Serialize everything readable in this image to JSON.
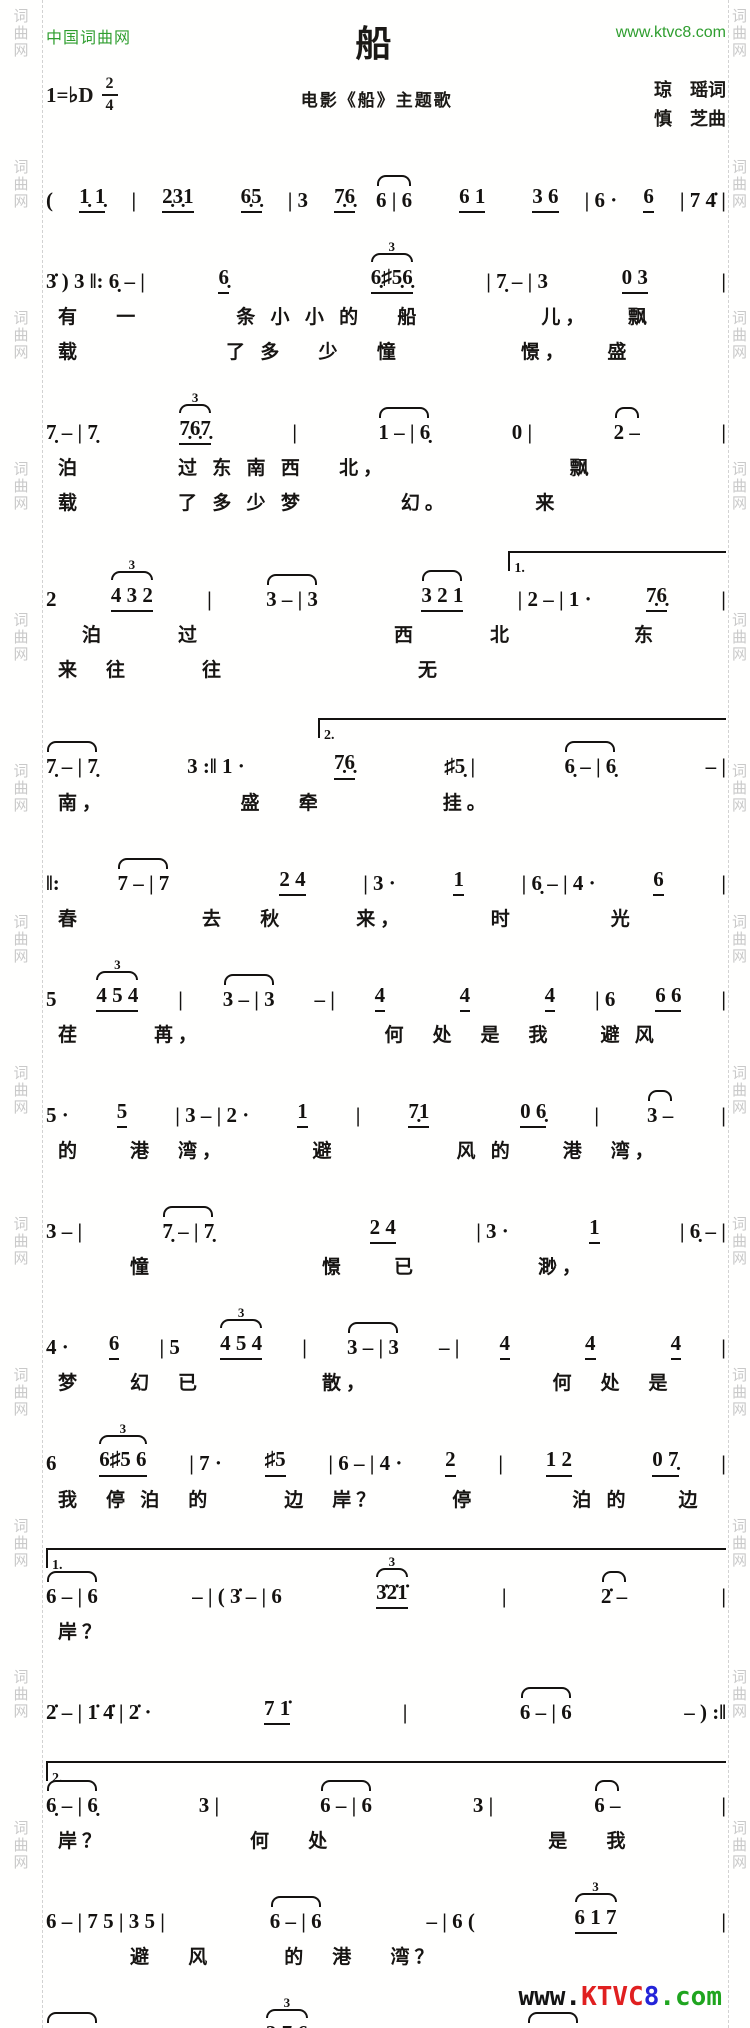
{
  "header": {
    "site_name": "中国词曲网",
    "site_url": "www.ktvc8.com",
    "title": "船",
    "key_signature": "1=♭D",
    "time_top": "2",
    "time_bottom": "4",
    "subtitle": "电影《船》主题歌",
    "lyricist": "琼　瑶词",
    "composer": "慎　芝曲"
  },
  "watermark": {
    "chars": [
      "词",
      "曲",
      "网"
    ],
    "groups": 13
  },
  "footer_logo": {
    "www": "www.",
    "ktvc": "KTVC",
    "eight": "8",
    "com": ".com"
  },
  "colors": {
    "site_green": "#2f9e2f",
    "logo_red": "#e02020",
    "logo_blue": "#2424d8",
    "logo_green": "#1fa51f",
    "ink": "#141210",
    "watermark_gray": "#c9c9c9"
  },
  "systems": [
    {
      "tokens": [
        {
          "t": "( "
        },
        {
          "t": "1̣ 1̣",
          "u": 1
        },
        {
          "t": " | "
        },
        {
          "t": "2̣3̣1",
          "u": 1
        },
        {
          "t": " "
        },
        {
          "t": "6̣5̣",
          "u": 1
        },
        {
          "t": " | 3 "
        },
        {
          "t": "7̣6̣",
          "u": 1
        },
        {
          "t": "6 | 6",
          "slur": 1
        },
        {
          "t": " "
        },
        {
          "t": "6 1",
          "u": 1
        },
        {
          "t": " "
        },
        {
          "t": "3 6",
          "u": 1
        },
        {
          "t": " | 6 · "
        },
        {
          "t": "6",
          "u": 1
        },
        {
          "t": " | 7 4̇ |"
        }
      ],
      "lyrics": []
    },
    {
      "tokens": [
        {
          "t": "3̇ ) 3 ‖: 6̣ – | "
        },
        {
          "t": "6̣",
          "u": 1
        },
        {
          "t": " "
        },
        {
          "t": "6̣♯5̣6̣",
          "u": 1,
          "tri": "3"
        },
        {
          "t": " | 7̣ – | 3 "
        },
        {
          "t": "0 3",
          "u": 1
        },
        {
          "t": " |"
        }
      ],
      "lyrics": [
        "有　 一　　　　条 小 小 的　 船　　　　　儿，　　飘",
        "载　　　　　　了 多　 少　 憧　　　　　憬，　　盛"
      ]
    },
    {
      "tokens": [
        {
          "t": "7̣ – | 7̣ "
        },
        {
          "t": "7̣6̣7̣",
          "u": 1,
          "tri": "3"
        },
        {
          "t": " | "
        },
        {
          "t": "1 – | 6̣",
          "slur": 1
        },
        {
          "t": " 0 | "
        },
        {
          "t": "2 –",
          "slur": 1
        },
        {
          "t": " |"
        }
      ],
      "lyrics": [
        "泊　　　　过 东 南 西　 北，　　　　　　　　飘",
        "载　　　　了 多 少 梦　　　　幻。　　　　来"
      ]
    },
    {
      "volta": {
        "label": "1.",
        "left": 68,
        "width": 32
      },
      "tokens": [
        {
          "t": "2 "
        },
        {
          "t": "4 3 2",
          "u": 1,
          "tri": "3"
        },
        {
          "t": " | "
        },
        {
          "t": "3 – | 3",
          "slur": 1
        },
        {
          "t": " "
        },
        {
          "t": "3 2 1",
          "u": 1,
          "slur": 1
        },
        {
          "t": " | 2 – | 1 · "
        },
        {
          "t": "7̣6̣",
          "u": 1
        },
        {
          "t": " |"
        }
      ],
      "lyrics": [
        "　泊　　　过　　　　　　　　西　　　北　　　　　东",
        "来　往　　　往　　　　　　　　无"
      ]
    },
    {
      "volta": {
        "label": "2.",
        "left": 40,
        "width": 60
      },
      "tokens": [
        {
          "t": "7̣ – | 7̣",
          "slur": 1
        },
        {
          "t": " 3 :‖ 1 · "
        },
        {
          "t": "7̣6̣",
          "u": 1
        },
        {
          "t": " ♯5̣ | "
        },
        {
          "t": "6̣ – | 6̣",
          "slur": 1
        },
        {
          "t": " – |"
        }
      ],
      "lyrics": [
        "南，　　　　　　盛　 牵　　　　　挂。"
      ]
    },
    {
      "tokens": [
        {
          "t": "‖: "
        },
        {
          "t": "7 – | 7",
          "slur": 1
        },
        {
          "t": " "
        },
        {
          "t": "2 4",
          "u": 1
        },
        {
          "t": " | 3 · "
        },
        {
          "t": "1",
          "u": 1
        },
        {
          "t": " | 6̣ – | 4 · "
        },
        {
          "t": "6",
          "u": 1
        },
        {
          "t": " |"
        }
      ],
      "lyrics": [
        "春　　　　　去　 秋　　　来，　　　　时　　　　光"
      ]
    },
    {
      "tokens": [
        {
          "t": "5 "
        },
        {
          "t": "4 5 4",
          "u": 1,
          "tri": "3"
        },
        {
          "t": " | "
        },
        {
          "t": "3 – | 3",
          "slur": 1
        },
        {
          "t": " – | "
        },
        {
          "t": "4",
          "u": 1
        },
        {
          "t": " "
        },
        {
          "t": "4",
          "u": 1
        },
        {
          "t": " "
        },
        {
          "t": "4",
          "u": 1
        },
        {
          "t": " | 6 "
        },
        {
          "t": "6 6",
          "u": 1
        },
        {
          "t": " |"
        }
      ],
      "lyrics": [
        "荏　　　苒，　　　　　　　　何　处　是　我　　避 风"
      ]
    },
    {
      "tokens": [
        {
          "t": "5 · "
        },
        {
          "t": "5",
          "u": 1
        },
        {
          "t": " | 3 – | 2 · "
        },
        {
          "t": "1",
          "u": 1
        },
        {
          "t": " | "
        },
        {
          "t": "7̣1",
          "u": 1
        },
        {
          "t": " "
        },
        {
          "t": "0 6̣",
          "u": 1
        },
        {
          "t": " | "
        },
        {
          "t": "3 –",
          "slur": 1
        },
        {
          "t": " |"
        }
      ],
      "lyrics": [
        "的　　港　湾，　　　　避　　　　　风 的　　港　湾，"
      ]
    },
    {
      "tokens": [
        {
          "t": "3 – | "
        },
        {
          "t": "7̣ – | 7̣",
          "slur": 1
        },
        {
          "t": " "
        },
        {
          "t": "2 4",
          "u": 1
        },
        {
          "t": " | 3 · "
        },
        {
          "t": "1",
          "u": 1
        },
        {
          "t": " | 6̣ – |"
        }
      ],
      "lyrics": [
        "　　　憧　　　　　　　憬　　已　　　　　渺，"
      ]
    },
    {
      "tokens": [
        {
          "t": "4 · "
        },
        {
          "t": "6",
          "u": 1
        },
        {
          "t": " | 5 "
        },
        {
          "t": "4 5 4",
          "u": 1,
          "tri": "3"
        },
        {
          "t": " | "
        },
        {
          "t": "3 – | 3",
          "slur": 1
        },
        {
          "t": " – | "
        },
        {
          "t": "4",
          "u": 1
        },
        {
          "t": " "
        },
        {
          "t": "4",
          "u": 1
        },
        {
          "t": " "
        },
        {
          "t": "4",
          "u": 1
        },
        {
          "t": " |"
        }
      ],
      "lyrics": [
        "梦　　幻　已　　　　　散，　　　　　　　　何　处　是"
      ]
    },
    {
      "tokens": [
        {
          "t": "6 "
        },
        {
          "t": "6♯5 6",
          "u": 1,
          "tri": "3"
        },
        {
          "t": " | 7 · "
        },
        {
          "t": "♯5",
          "u": 1
        },
        {
          "t": " | 6 – | 4 · "
        },
        {
          "t": "2",
          "u": 1
        },
        {
          "t": " | "
        },
        {
          "t": "1 2",
          "u": 1
        },
        {
          "t": " "
        },
        {
          "t": "0 7̣",
          "u": 1
        },
        {
          "t": " |"
        }
      ],
      "lyrics": [
        "我　停 泊　的　　　边　岸？　　　停　　　　泊 的　　边"
      ]
    },
    {
      "volta": {
        "label": "1.",
        "left": 0,
        "width": 100
      },
      "tokens": [
        {
          "t": "6 – | 6",
          "slur": 1
        },
        {
          "t": " – | ( 3̇ – | 6 "
        },
        {
          "t": "3̇2̇1̇",
          "u": 1,
          "tri": "3"
        },
        {
          "t": " | "
        },
        {
          "t": "2̇ –",
          "slur": 1
        },
        {
          "t": " |"
        }
      ],
      "lyrics": [
        "岸？"
      ]
    },
    {
      "tokens": [
        {
          "t": "2̇ – | 1̇ 4̇ | 2̇ · "
        },
        {
          "t": "7 1̇",
          "u": 1
        },
        {
          "t": " | "
        },
        {
          "t": "6 – | 6",
          "slur": 1
        },
        {
          "t": " – ) :‖"
        }
      ],
      "lyrics": []
    },
    {
      "volta": {
        "label": "2.",
        "left": 0,
        "width": 100
      },
      "tokens": [
        {
          "t": "6̣ – | 6̣",
          "slur": 1
        },
        {
          "t": " 3 | "
        },
        {
          "t": "6 – | 6",
          "slur": 1
        },
        {
          "t": " 3 | "
        },
        {
          "t": "6 –",
          "slur": 1
        },
        {
          "t": " |"
        }
      ],
      "lyrics": [
        "岸？　　　　　　何　 处　　　　　　　　　是　 我"
      ]
    },
    {
      "tokens": [
        {
          "t": "6 – | 7 5 | 3 5 | "
        },
        {
          "t": "6 – | 6",
          "slur": 1
        },
        {
          "t": " – | 6 ("
        },
        {
          "t": "6 1 7",
          "u": 1,
          "tri": "3"
        },
        {
          "t": " |"
        }
      ],
      "lyrics": [
        "　　　避　 风　　　的　港　 湾？"
      ]
    },
    {
      "tokens": [
        {
          "t": "1̇ – | 1̇",
          "slur": 1
        },
        {
          "t": " "
        },
        {
          "t": "3 7 6",
          "u": 1,
          "tri": "3"
        },
        {
          "t": " | 7 5 | "
        },
        {
          "t": "6 – | 6",
          "slur": 1
        },
        {
          "t": " – | 6 ) ‖"
        }
      ],
      "lyrics": []
    }
  ]
}
